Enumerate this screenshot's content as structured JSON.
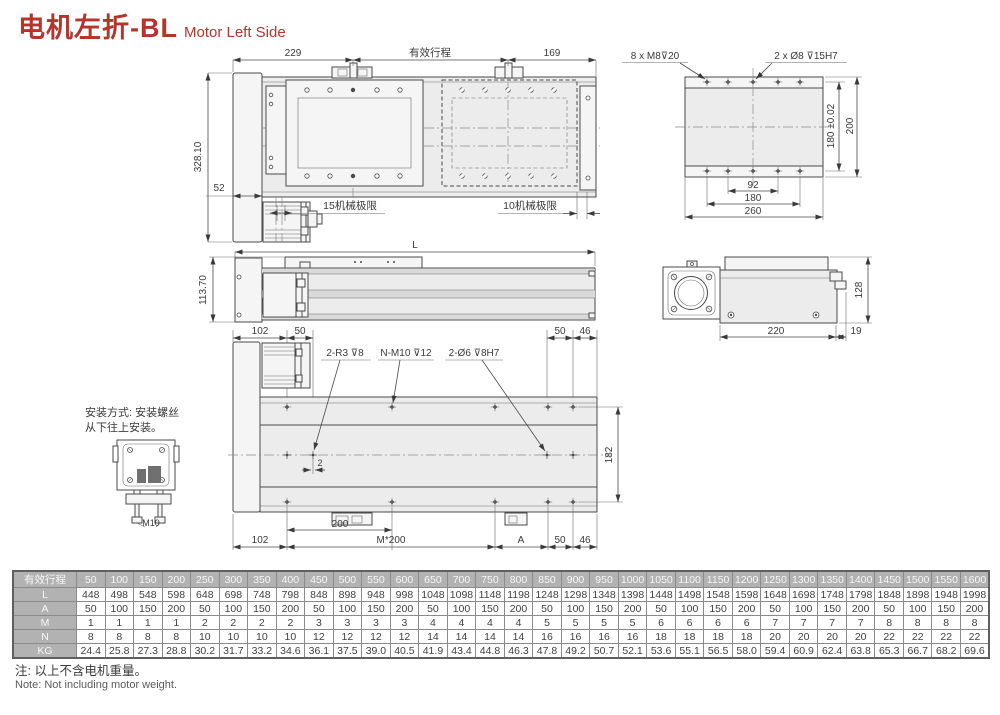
{
  "title": {
    "zh": "电机左折-BL",
    "en": "Motor Left Side"
  },
  "colors": {
    "accent": "#b5352d",
    "line": "#4a4a4a",
    "fill_light": "#ececec",
    "table_header_bg": "#b2b2b2",
    "table_header_text": "#f7f7f7",
    "table_value_text": "#3f3f3f"
  },
  "top_view": {
    "dim_229": "229",
    "stroke_label": "有效行程",
    "dim_169": "169",
    "dim_328": "328.10",
    "dim_52": "52",
    "limit_left": "15机械极限",
    "limit_right": "10机械极限"
  },
  "end_view": {
    "label_m8": "8 x M8⊽20",
    "label_dowel": "2 x Ø8 ⊽15H7",
    "dim_180_tol": "180 ±0.02",
    "dim_200": "200",
    "dim_92": "92",
    "dim_180": "180",
    "dim_260": "260"
  },
  "side_view": {
    "dim_L": "L",
    "dim_113": "113.70"
  },
  "motor_view": {
    "dim_128": "128",
    "dim_220": "220",
    "dim_19": "19"
  },
  "bottom_view": {
    "dim_102_top": "102",
    "dim_50_tl": "50",
    "dim_50_tr": "50",
    "dim_46_tr": "46",
    "label_r3": "2-R3 ⊽8",
    "label_m10": "N-M10 ⊽12",
    "label_dowel": "2-Ø6 ⊽8H7",
    "dim_2": "2",
    "dim_182": "182",
    "dim_200": "200",
    "dim_102_bot": "102",
    "dim_m200": "M*200",
    "dim_A": "A",
    "dim_50_br": "50",
    "dim_46_br": "46"
  },
  "install": {
    "line1": "安装方式: 安装螺丝",
    "line2": "从下往上安装。",
    "bolt_label": "M10"
  },
  "table": {
    "corner": "有效行程",
    "strokes": [
      "50",
      "100",
      "150",
      "200",
      "250",
      "300",
      "350",
      "400",
      "450",
      "500",
      "550",
      "600",
      "650",
      "700",
      "750",
      "800",
      "850",
      "900",
      "950",
      "1000",
      "1050",
      "1100",
      "1150",
      "1200",
      "1250",
      "1300",
      "1350",
      "1400",
      "1450",
      "1500",
      "1550",
      "1600"
    ],
    "rows": [
      {
        "label": "L",
        "values": [
          "448",
          "498",
          "548",
          "598",
          "648",
          "698",
          "748",
          "798",
          "848",
          "898",
          "948",
          "998",
          "1048",
          "1098",
          "1148",
          "1198",
          "1248",
          "1298",
          "1348",
          "1398",
          "1448",
          "1498",
          "1548",
          "1598",
          "1648",
          "1698",
          "1748",
          "1798",
          "1848",
          "1898",
          "1948",
          "1998"
        ]
      },
      {
        "label": "A",
        "values": [
          "50",
          "100",
          "150",
          "200",
          "50",
          "100",
          "150",
          "200",
          "50",
          "100",
          "150",
          "200",
          "50",
          "100",
          "150",
          "200",
          "50",
          "100",
          "150",
          "200",
          "50",
          "100",
          "150",
          "200",
          "50",
          "100",
          "150",
          "200",
          "50",
          "100",
          "150",
          "200"
        ]
      },
      {
        "label": "M",
        "values": [
          "1",
          "1",
          "1",
          "1",
          "2",
          "2",
          "2",
          "2",
          "3",
          "3",
          "3",
          "3",
          "4",
          "4",
          "4",
          "4",
          "5",
          "5",
          "5",
          "5",
          "6",
          "6",
          "6",
          "6",
          "7",
          "7",
          "7",
          "7",
          "8",
          "8",
          "8",
          "8"
        ]
      },
      {
        "label": "N",
        "values": [
          "8",
          "8",
          "8",
          "8",
          "10",
          "10",
          "10",
          "10",
          "12",
          "12",
          "12",
          "12",
          "14",
          "14",
          "14",
          "14",
          "16",
          "16",
          "16",
          "16",
          "18",
          "18",
          "18",
          "18",
          "20",
          "20",
          "20",
          "20",
          "22",
          "22",
          "22",
          "22"
        ]
      },
      {
        "label": "KG",
        "values": [
          "24.4",
          "25.8",
          "27.3",
          "28.8",
          "30.2",
          "31.7",
          "33.2",
          "34.6",
          "36.1",
          "37.5",
          "39.0",
          "40.5",
          "41.9",
          "43.4",
          "44.8",
          "46.3",
          "47.8",
          "49.2",
          "50.7",
          "52.1",
          "53.6",
          "55.1",
          "56.5",
          "58.0",
          "59.4",
          "60.9",
          "62.4",
          "63.8",
          "65.3",
          "66.7",
          "68.2",
          "69.6"
        ]
      }
    ]
  },
  "note": {
    "zh": "注: 以上不含电机重量。",
    "en": "Note: Not including motor weight."
  }
}
